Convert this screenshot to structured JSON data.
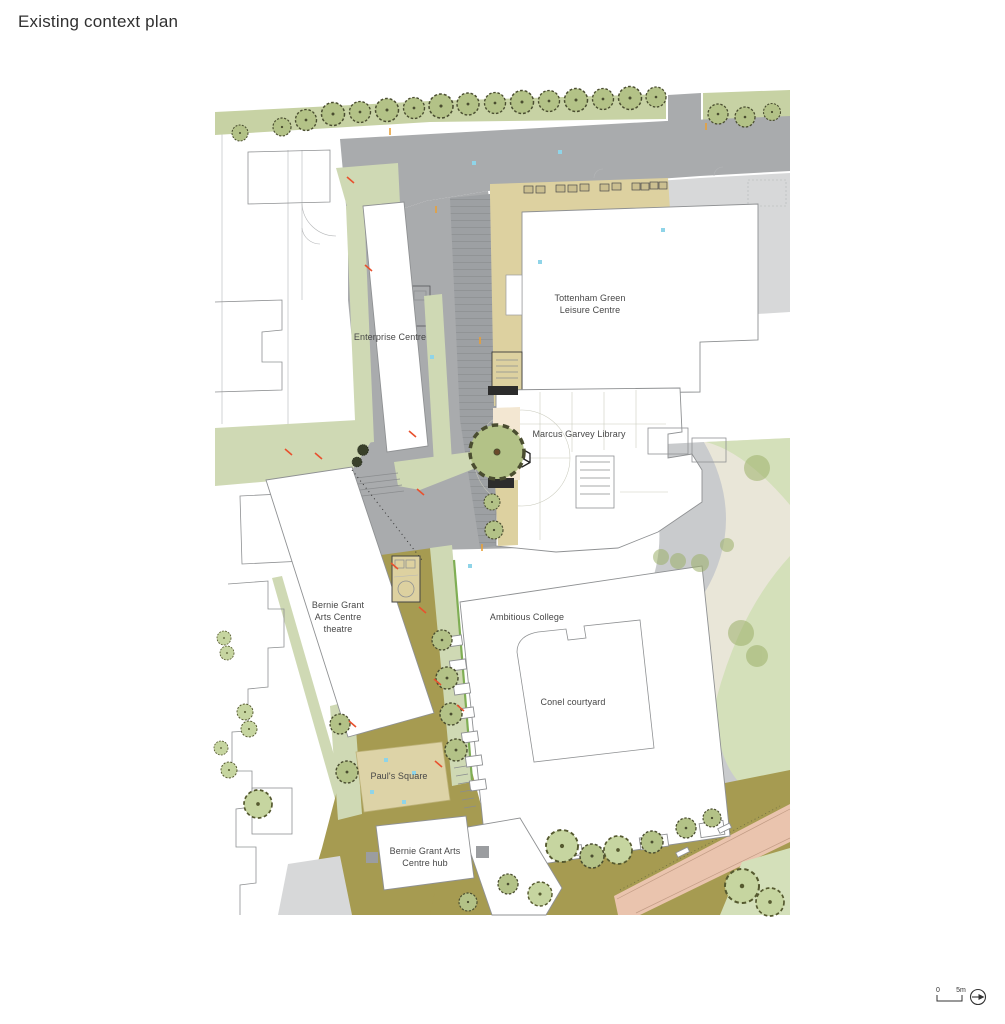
{
  "title": "Existing context plan",
  "map": {
    "labels": {
      "enterprise": "Enterprise Centre",
      "leisure": {
        "line1": "Tottenham Green",
        "line2": "Leisure Centre"
      },
      "library": "Marcus Garvey Library",
      "theatre": {
        "line1": "Bernie Grant",
        "line2": "Arts Centre",
        "line3": "theatre"
      },
      "college": "Ambitious College",
      "courtyard": "Conel courtyard",
      "pauls_square": "Paul's Square",
      "hub": {
        "line1": "Bernie Grant Arts",
        "line2": "Centre hub"
      }
    },
    "colors": {
      "road": "#a9abad",
      "road_dark": "#9da0a3",
      "pavement": "#d7d8d9",
      "pave_mid": "#c9cbcd",
      "verge": "#c7d2a4",
      "sage": "#cfd9b4",
      "lawn": "#d4e0ba",
      "park_path": "#e9e6d8",
      "tan": "#ddd1a0",
      "cream": "#f3e7d2",
      "olive": "#a69b51",
      "square_tan": "#ddd3a7",
      "salmon": "#eac4ae",
      "hedge": "#7fae54",
      "building": "#ffffff",
      "outline": "#8f9193",
      "label": "#474747",
      "marker_red": "#e8512e",
      "marker_cyan": "#8fd4e8",
      "marker_orange": "#e8a13a"
    }
  },
  "scale_bar": {
    "start": "0",
    "end": "5m"
  }
}
